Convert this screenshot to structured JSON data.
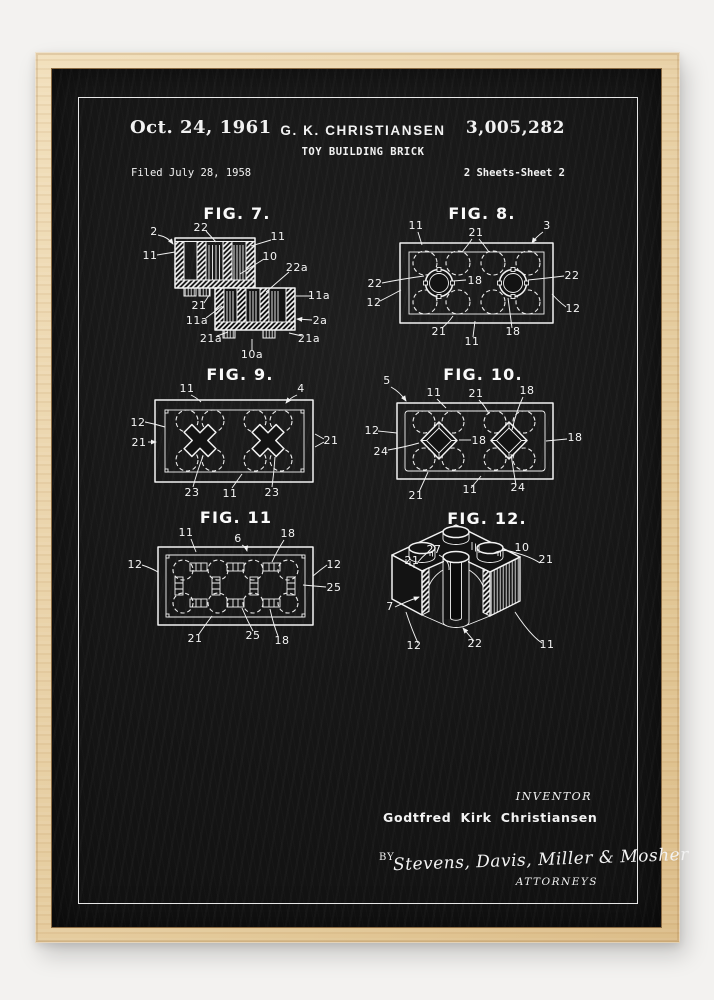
{
  "colors": {
    "background": "#f3f2f0",
    "frame_wood": "#e8d0a6",
    "poster": "#151515",
    "ink": "#f2f2f2"
  },
  "header": {
    "date": "Oct. 24, 1961",
    "inventor_name": "G. K. CHRISTIANSEN",
    "patent_title": "TOY BUILDING BRICK",
    "patent_number": "3,005,282",
    "filed": "Filed July 28, 1958",
    "sheet": "2 Sheets-Sheet 2"
  },
  "figures": {
    "fig7": {
      "title": "FIG. 7.",
      "labels": [
        "2",
        "22",
        "11",
        "11",
        "10",
        "22a",
        "21",
        "11a",
        "11a",
        "2a",
        "21a",
        "10a",
        "21a"
      ]
    },
    "fig8": {
      "title": "FIG. 8.",
      "labels": [
        "11",
        "21",
        "3",
        "22",
        "12",
        "18",
        "22",
        "12",
        "21",
        "11",
        "18"
      ]
    },
    "fig9": {
      "title": "FIG. 9.",
      "labels": [
        "11",
        "4",
        "12",
        "21",
        "21",
        "23",
        "11",
        "23"
      ]
    },
    "fig10": {
      "title": "FIG. 10.",
      "labels": [
        "5",
        "11",
        "21",
        "18",
        "12",
        "24",
        "18",
        "18",
        "21",
        "11",
        "24"
      ]
    },
    "fig11": {
      "title": "FIG. 11",
      "labels": [
        "11",
        "6",
        "18",
        "12",
        "12",
        "25",
        "21",
        "25",
        "18"
      ]
    },
    "fig12": {
      "title": "FIG. 12.",
      "labels": [
        "27",
        "10",
        "21",
        "21",
        "7",
        "12",
        "22",
        "11"
      ]
    }
  },
  "footer": {
    "inventor_heading": "INVENTOR",
    "inventor_name": "Godtfred Kirk Christiansen",
    "by_label": "BY",
    "signature": "Stevens, Davis, Miller & Mosher",
    "attorneys_label": "ATTORNEYS"
  }
}
